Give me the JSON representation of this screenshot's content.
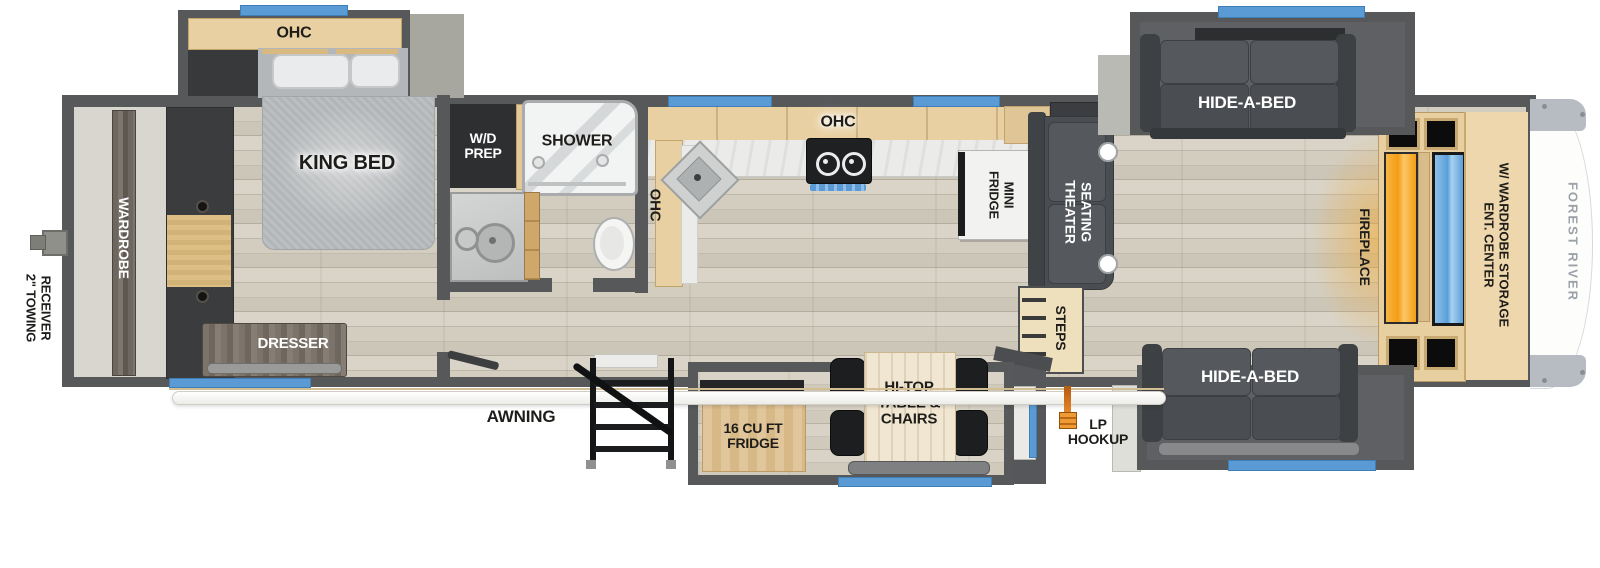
{
  "labels": {
    "towing": {
      "lines": [
        "2\" TOWING",
        "RECEIVER"
      ]
    },
    "wardrobe": "WARDROBE",
    "bedroom_ohc": "OHC",
    "king_bed": "KING BED",
    "dresser": "DRESSER",
    "wd_prep": {
      "lines": [
        "W/D",
        "PREP"
      ]
    },
    "shower": "SHOWER",
    "kitchen_ohc_left": "OHC",
    "kitchen_ohc_top": "OHC",
    "mini_fridge": {
      "lines": [
        "MINI",
        "FRIDGE"
      ]
    },
    "theater_seating": {
      "lines": [
        "THEATER",
        "SEATING"
      ]
    },
    "steps": "STEPS",
    "hide_a_bed_top": "HIDE-A-BED",
    "hide_a_bed_bottom": "HIDE-A-BED",
    "fireplace": "FIREPLACE",
    "ent_center": {
      "lines": [
        "ENT. CENTER",
        "W/ WARDROBE STORAGE"
      ]
    },
    "awning": "AWNING",
    "exterior_fridge": {
      "lines": [
        "16 CU FT",
        "FRIDGE"
      ]
    },
    "hi_top_table": {
      "lines": [
        "HI-TOP",
        "TABLE &",
        "CHAIRS"
      ]
    },
    "lp_hookup": {
      "lines": [
        "LP",
        "HOOKUP"
      ]
    },
    "brand": "FOREST RIVER"
  },
  "colors": {
    "wall": "#56585a",
    "window_blue": "#5b9bd5",
    "cabinet_wood": "#e9d0a2",
    "fireplace_orange": "#f5a11c",
    "tv_blue": "#5a9fd9",
    "lp_orange": "#e8882a",
    "front_cap_trim": "#b6bcc2"
  }
}
